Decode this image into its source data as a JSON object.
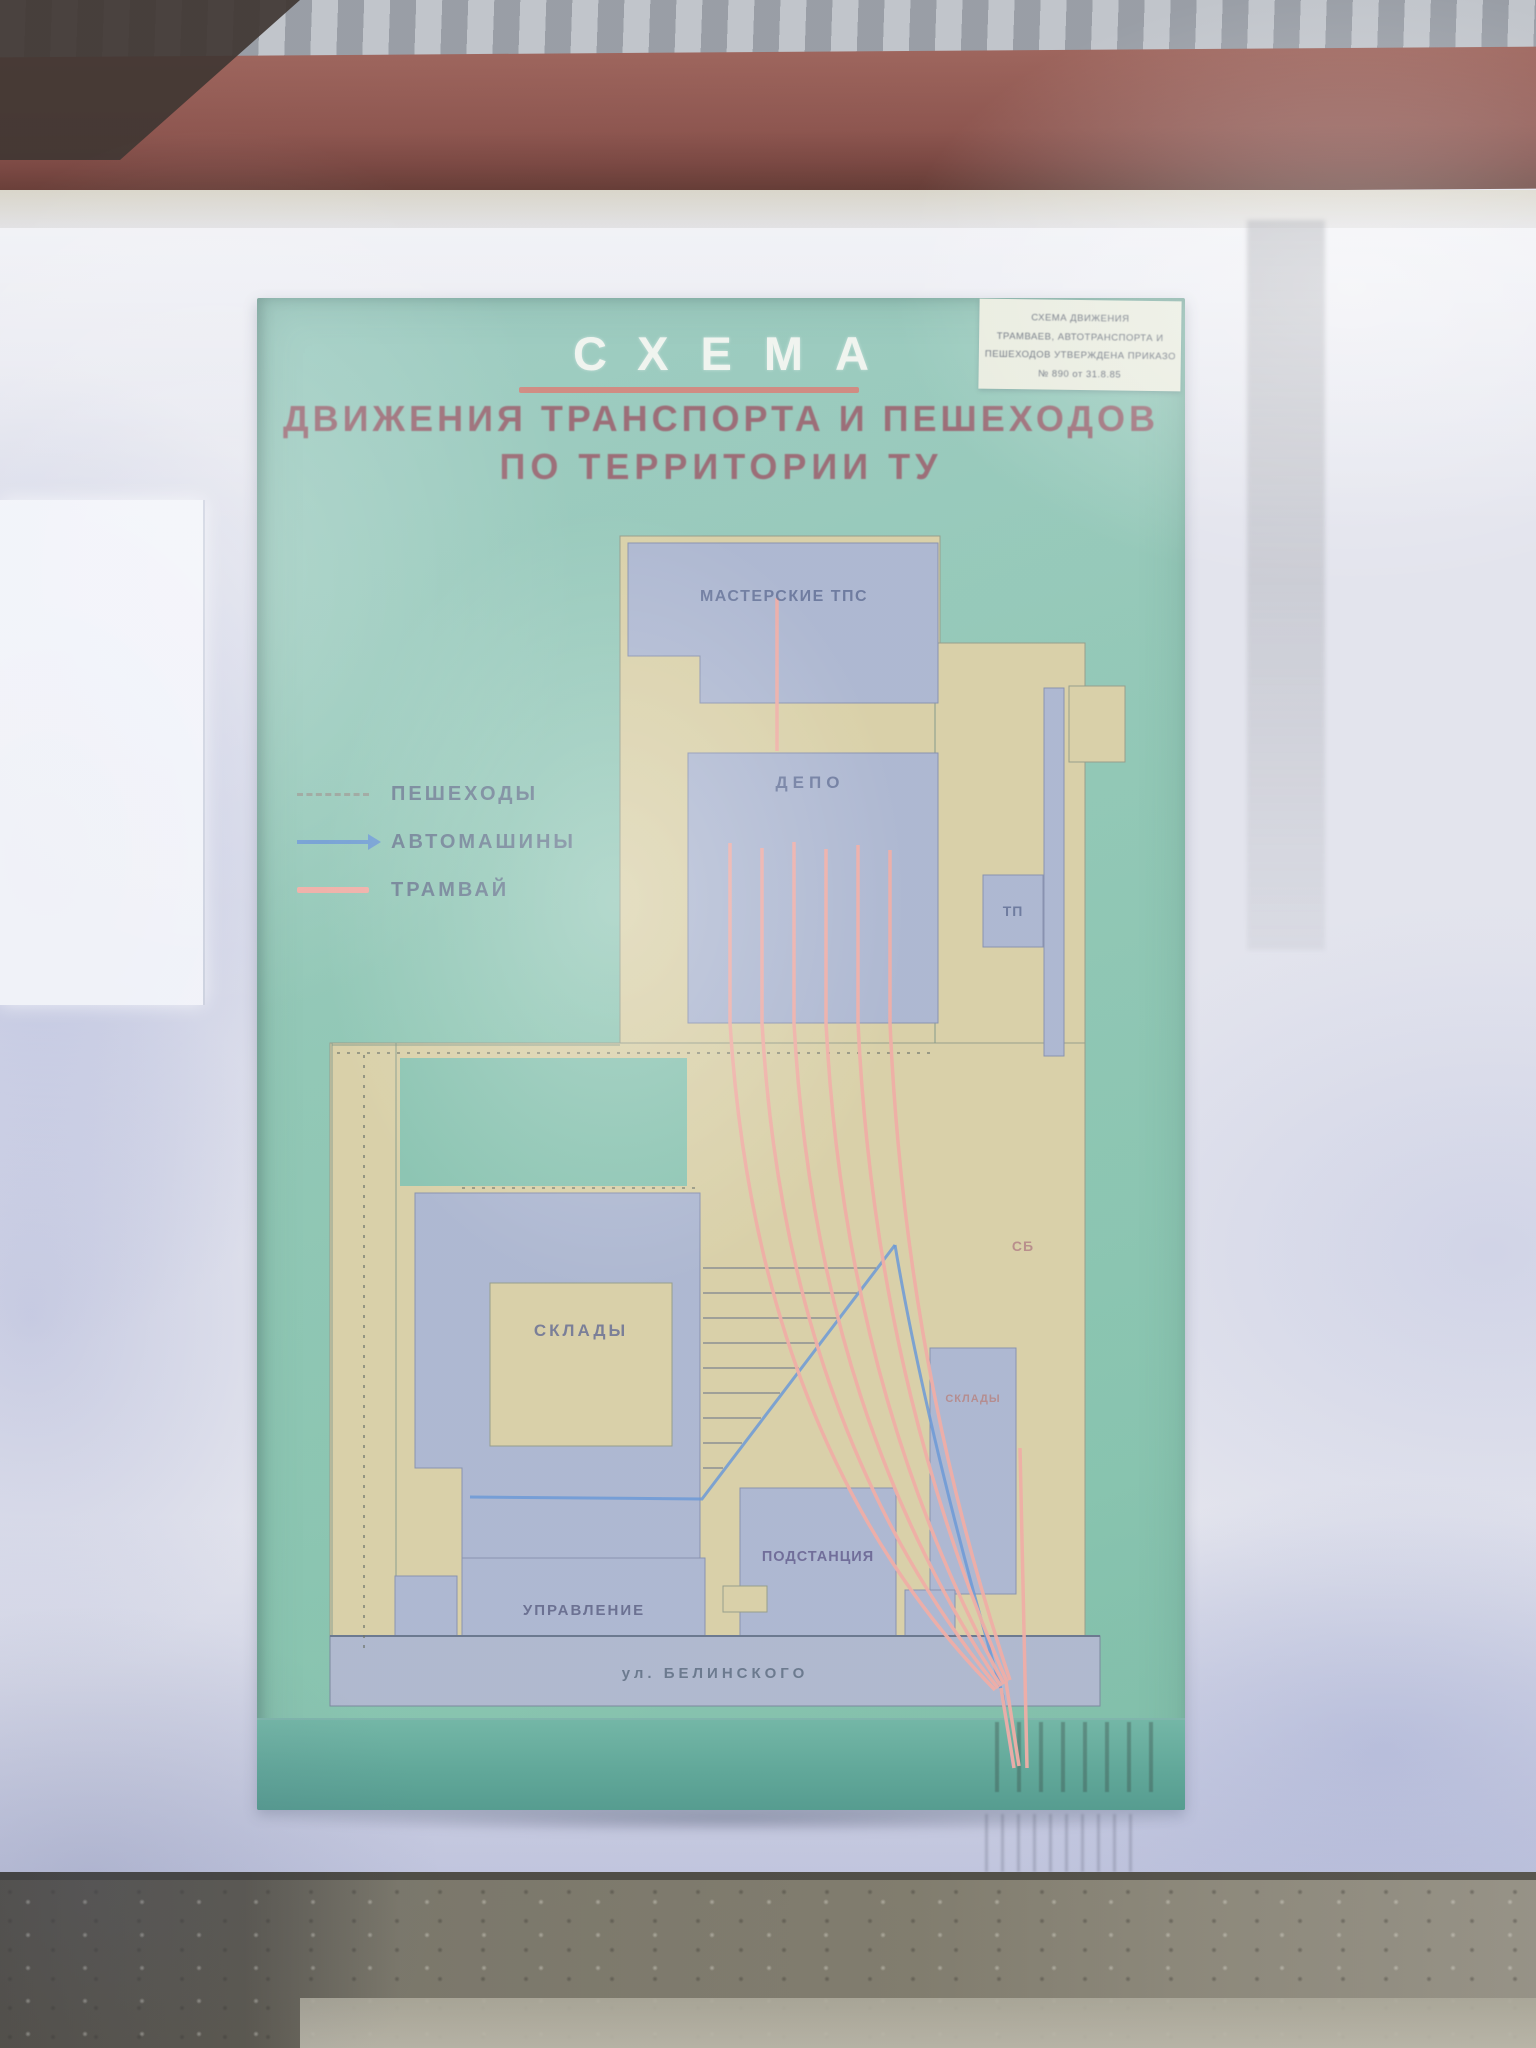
{
  "colors": {
    "panel_teal": "#87c3ae",
    "panel_teal_dark": "#4f9c8b",
    "area_yellow": "#d7cda0",
    "building_blue": "#a7b2cd",
    "street_gray": "#a9b3ca",
    "tram_pink": "#efa79d",
    "car_blue": "#5e8fd2",
    "underline_red": "#d7746a",
    "subtitle_red": "#93606a",
    "title_white": "#f1f4ee",
    "label_blue": "#5c6a92",
    "label_red": "#b07e7e",
    "beam_red": "#7e4038",
    "wall_white": "#e2e3ec",
    "ground_gray": "#6e6a5b"
  },
  "sign": {
    "title": "СХЕМА",
    "subtitle_line1": "ДВИЖЕНИЯ ТРАНСПОРТА И ПЕШЕХОДОВ",
    "subtitle_line2": "ПО ТЕРРИТОРИИ ТУ",
    "plaque": {
      "lines": [
        "СХЕМА ДВИЖЕНИЯ",
        "ТРАМВАЕВ, АВТОТРАНСПОРТА И",
        "ПЕШЕХОДОВ УТВЕРЖДЕНА ПРИКАЗОМ",
        "№ 890 от 31.8.85"
      ]
    },
    "legend": {
      "items": [
        {
          "label": "ПЕШЕХОДЫ",
          "symbol": "dotted-line"
        },
        {
          "label": "АВТОМАШИНЫ",
          "symbol": "arrow-line"
        },
        {
          "label": "ТРАМВАЙ",
          "symbol": "solid-line"
        }
      ]
    },
    "map": {
      "labels": {
        "workshops": "МАСТЕРСКИЕ ТПС",
        "depot": "ДЕПО",
        "substation_small": "ТП",
        "sb": "СБ",
        "warehouses_main": "СКЛАДЫ",
        "warehouses_right": "СКЛАДЫ",
        "traction_substation": "ПОДСТАНЦИЯ",
        "administration": "УПРАВЛЕНИЕ",
        "street": "ул. БЕЛИНСКОГО"
      }
    }
  }
}
